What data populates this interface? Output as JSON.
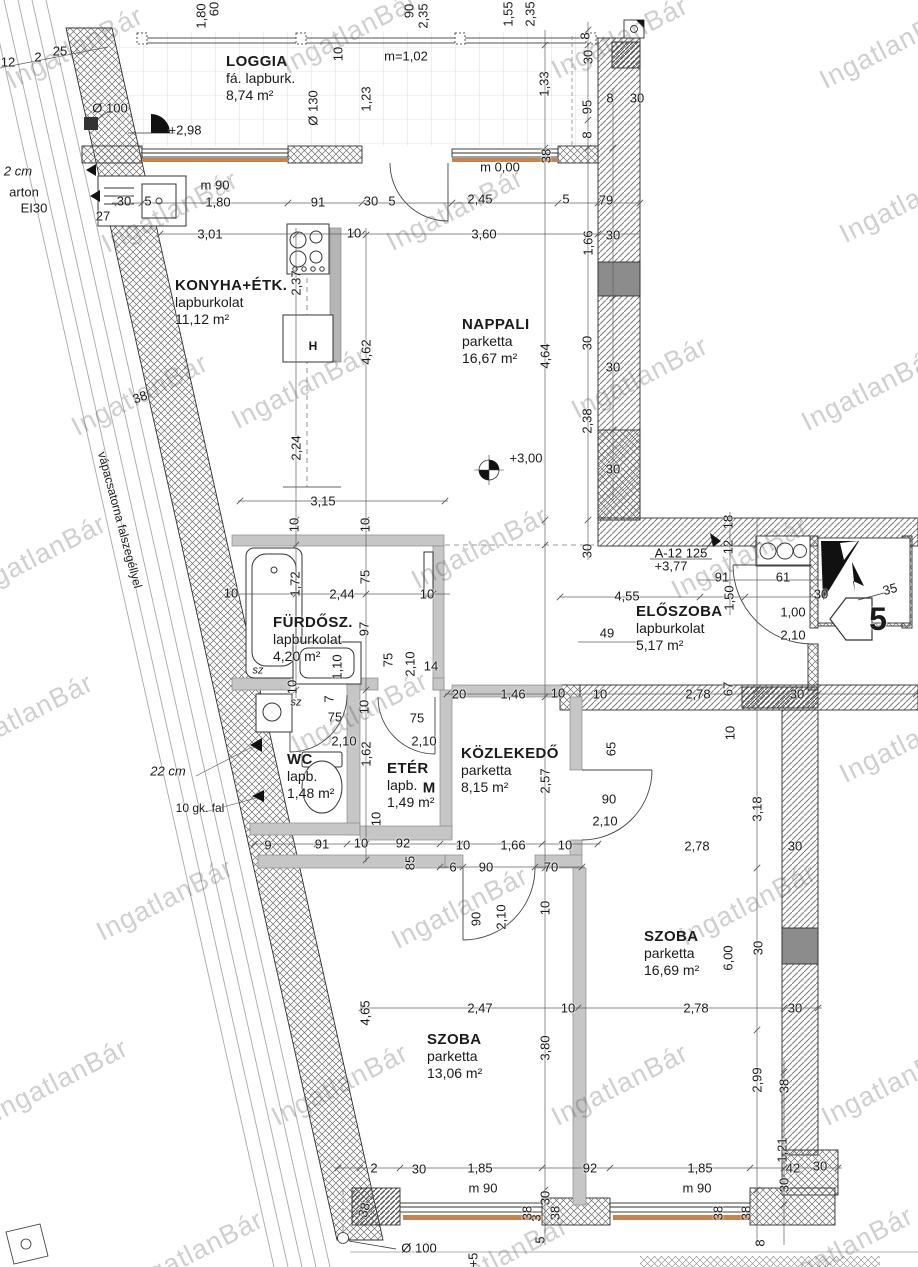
{
  "watermark_text": "IngatlanBár",
  "plan": {
    "apartment_number": "5",
    "shaft_label": "A-12 125",
    "shaft_level": "+3,77"
  },
  "rooms": [
    {
      "name": "LOGGIA",
      "finish": "fá. lapburk.",
      "area": "8,74 m²",
      "x": 226,
      "y": 53
    },
    {
      "name": "KONYHA+ÉTK.",
      "finish": "lapburkolat",
      "area": "11,12 m²",
      "x": 175,
      "y": 277
    },
    {
      "name": "NAPPALI",
      "finish": "parketta",
      "area": "16,67 m²",
      "x": 462,
      "y": 316
    },
    {
      "name": "FÜRDŐSZ.",
      "finish": "lapburkolat",
      "area": "4,20 m²",
      "x": 273,
      "y": 614
    },
    {
      "name": "ELŐSZOBA",
      "finish": "lapburkolat",
      "area": "5,17 m²",
      "x": 636,
      "y": 603
    },
    {
      "name": "WC",
      "finish": "lapb.",
      "area": "1,48 m²",
      "x": 287,
      "y": 751
    },
    {
      "name": "ETÉR",
      "finish": "lapb.",
      "area": "1,49 m²",
      "x": 387,
      "y": 760
    },
    {
      "name": "KÖZLEKEDŐ",
      "finish": "parketta",
      "area": "8,15 m²",
      "x": 461,
      "y": 745
    },
    {
      "name": "SZOBA",
      "finish": "parketta",
      "area": "16,69 m²",
      "x": 644,
      "y": 928
    },
    {
      "name": "SZOBA",
      "finish": "parketta",
      "area": "13,06 m²",
      "x": 427,
      "y": 1031
    }
  ],
  "labels": [
    {
      "t": "1,80",
      "x": 201,
      "y": 16,
      "r": -90
    },
    {
      "t": "60",
      "x": 214,
      "y": 9,
      "r": -90
    },
    {
      "t": "90",
      "x": 409,
      "y": 11,
      "r": -90
    },
    {
      "t": "2,35",
      "x": 423,
      "y": 16,
      "r": -90
    },
    {
      "t": "1,55",
      "x": 508,
      "y": 14,
      "r": -90
    },
    {
      "t": "2,35",
      "x": 530,
      "y": 14,
      "r": -90
    },
    {
      "t": "25",
      "x": 60,
      "y": 51
    },
    {
      "t": "2",
      "x": 38,
      "y": 57
    },
    {
      "t": "12",
      "x": 8,
      "y": 62
    },
    {
      "t": "m=1,02",
      "x": 406,
      "y": 56
    },
    {
      "t": "10",
      "x": 338,
      "y": 54,
      "r": -90
    },
    {
      "t": "1,23",
      "x": 366,
      "y": 99,
      "r": -90
    },
    {
      "t": "Ø 130",
      "x": 313,
      "y": 108,
      "r": -90
    },
    {
      "t": "Ø 100",
      "x": 110,
      "y": 108
    },
    {
      "t": "+2,98",
      "x": 185,
      "y": 130
    },
    {
      "t": "8",
      "x": 585,
      "y": 36,
      "r": -90
    },
    {
      "t": "30",
      "x": 588,
      "y": 57,
      "r": -90
    },
    {
      "t": "1,33",
      "x": 544,
      "y": 84,
      "r": -90
    },
    {
      "t": "95",
      "x": 587,
      "y": 107,
      "r": -90
    },
    {
      "t": "8",
      "x": 587,
      "y": 135,
      "r": -90
    },
    {
      "t": "8",
      "x": 610,
      "y": 98
    },
    {
      "t": "30",
      "x": 637,
      "y": 98
    },
    {
      "t": "38",
      "x": 546,
      "y": 156,
      "r": -90
    },
    {
      "t": "m 0,00",
      "x": 500,
      "y": 167
    },
    {
      "t": "m 90",
      "x": 215,
      "y": 185
    },
    {
      "t": "30",
      "x": 124,
      "y": 201
    },
    {
      "t": "5",
      "x": 148,
      "y": 201
    },
    {
      "t": "1,80",
      "x": 218,
      "y": 202
    },
    {
      "t": "91",
      "x": 318,
      "y": 202
    },
    {
      "t": "30",
      "x": 371,
      "y": 201
    },
    {
      "t": "5",
      "x": 392,
      "y": 201
    },
    {
      "t": "2,45",
      "x": 480,
      "y": 199
    },
    {
      "t": "5",
      "x": 566,
      "y": 199
    },
    {
      "t": "79",
      "x": 606,
      "y": 200
    },
    {
      "t": "27",
      "x": 103,
      "y": 216
    },
    {
      "t": "3,01",
      "x": 210,
      "y": 234
    },
    {
      "t": "10",
      "x": 354,
      "y": 233
    },
    {
      "t": "3,60",
      "x": 484,
      "y": 234
    },
    {
      "t": "30",
      "x": 613,
      "y": 235
    },
    {
      "t": "1,66",
      "x": 588,
      "y": 243,
      "r": -90
    },
    {
      "t": "2,37",
      "x": 296,
      "y": 283,
      "r": -90
    },
    {
      "t": "4,62",
      "x": 366,
      "y": 352,
      "r": -90
    },
    {
      "t": "4,64",
      "x": 545,
      "y": 356,
      "r": -90
    },
    {
      "t": "30",
      "x": 587,
      "y": 343,
      "r": -90
    },
    {
      "t": "30",
      "x": 613,
      "y": 367
    },
    {
      "t": "2,38",
      "x": 587,
      "y": 421,
      "r": -90
    },
    {
      "t": "30",
      "x": 613,
      "y": 469
    },
    {
      "t": "+3,00",
      "x": 526,
      "y": 458
    },
    {
      "t": "38",
      "x": 140,
      "y": 397,
      "r": -20
    },
    {
      "t": "2,24",
      "x": 296,
      "y": 448,
      "r": -90
    },
    {
      "t": "3,15",
      "x": 323,
      "y": 501
    },
    {
      "t": "10",
      "x": 294,
      "y": 525,
      "r": -90
    },
    {
      "t": "10",
      "x": 365,
      "y": 525,
      "r": -90
    },
    {
      "t": "1,72",
      "x": 295,
      "y": 584,
      "r": -90
    },
    {
      "t": "2,44",
      "x": 342,
      "y": 594
    },
    {
      "t": "75",
      "x": 365,
      "y": 577,
      "r": -90
    },
    {
      "t": "10",
      "x": 231,
      "y": 593
    },
    {
      "t": "10",
      "x": 427,
      "y": 594
    },
    {
      "t": "97",
      "x": 364,
      "y": 629,
      "r": -90
    },
    {
      "t": "sz",
      "x": 258,
      "y": 671,
      "s": 11,
      "i": 1
    },
    {
      "t": "sz",
      "x": 296,
      "y": 703,
      "s": 11,
      "i": 1
    },
    {
      "t": "1,10",
      "x": 337,
      "y": 667,
      "r": -90
    },
    {
      "t": "75",
      "x": 388,
      "y": 660,
      "r": -90
    },
    {
      "t": "2,10",
      "x": 410,
      "y": 664,
      "r": -90
    },
    {
      "t": "14",
      "x": 431,
      "y": 666
    },
    {
      "t": "18",
      "x": 728,
      "y": 522,
      "r": -90
    },
    {
      "t": "12",
      "x": 728,
      "y": 547,
      "r": -90
    },
    {
      "t": "30",
      "x": 587,
      "y": 551,
      "r": -90
    },
    {
      "t": "A-12 125",
      "x": 681,
      "y": 553
    },
    {
      "t": "+3,77",
      "x": 671,
      "y": 566
    },
    {
      "t": "91",
      "x": 722,
      "y": 577
    },
    {
      "t": "61",
      "x": 783,
      "y": 577
    },
    {
      "t": "4,55",
      "x": 627,
      "y": 596
    },
    {
      "t": "1,50",
      "x": 729,
      "y": 598,
      "r": -90
    },
    {
      "t": "30",
      "x": 821,
      "y": 594
    },
    {
      "t": "35",
      "x": 890,
      "y": 589,
      "r": -15
    },
    {
      "t": "1,00",
      "x": 793,
      "y": 612
    },
    {
      "t": "2,10",
      "x": 793,
      "y": 635
    },
    {
      "t": "49",
      "x": 607,
      "y": 633
    },
    {
      "t": "5",
      "x": 878,
      "y": 619,
      "s": 32,
      "b": 1,
      "n": "apartment-number"
    },
    {
      "t": "20",
      "x": 459,
      "y": 694
    },
    {
      "t": "1,46",
      "x": 513,
      "y": 694
    },
    {
      "t": "10",
      "x": 558,
      "y": 693
    },
    {
      "t": "10",
      "x": 600,
      "y": 694
    },
    {
      "t": "2,78",
      "x": 698,
      "y": 694
    },
    {
      "t": "67",
      "x": 728,
      "y": 689,
      "r": -90
    },
    {
      "t": "30",
      "x": 797,
      "y": 694
    },
    {
      "t": "10",
      "x": 292,
      "y": 687,
      "r": -90
    },
    {
      "t": "7",
      "x": 329,
      "y": 699,
      "r": -90
    },
    {
      "t": "10",
      "x": 364,
      "y": 707,
      "r": -90
    },
    {
      "t": "75",
      "x": 335,
      "y": 717
    },
    {
      "t": "2,10",
      "x": 344,
      "y": 741
    },
    {
      "t": "75",
      "x": 417,
      "y": 718
    },
    {
      "t": "2,10",
      "x": 424,
      "y": 741
    },
    {
      "t": "1,62",
      "x": 366,
      "y": 754,
      "r": -90
    },
    {
      "t": "2,57",
      "x": 545,
      "y": 781,
      "r": -90
    },
    {
      "t": "65",
      "x": 611,
      "y": 749,
      "r": -90
    },
    {
      "t": "10",
      "x": 730,
      "y": 733,
      "r": -90
    },
    {
      "t": "90",
      "x": 609,
      "y": 799
    },
    {
      "t": "2,10",
      "x": 605,
      "y": 821
    },
    {
      "t": "3,18",
      "x": 757,
      "y": 809,
      "r": -90
    },
    {
      "t": "10",
      "x": 376,
      "y": 819,
      "r": -90
    },
    {
      "t": "9",
      "x": 268,
      "y": 845
    },
    {
      "t": "91",
      "x": 322,
      "y": 844
    },
    {
      "t": "10",
      "x": 361,
      "y": 843
    },
    {
      "t": "92",
      "x": 403,
      "y": 843
    },
    {
      "t": "85",
      "x": 410,
      "y": 863,
      "r": -90
    },
    {
      "t": "10",
      "x": 463,
      "y": 845
    },
    {
      "t": "1,66",
      "x": 513,
      "y": 845
    },
    {
      "t": "10",
      "x": 565,
      "y": 845
    },
    {
      "t": "2,78",
      "x": 697,
      "y": 846
    },
    {
      "t": "30",
      "x": 795,
      "y": 846
    },
    {
      "t": "6",
      "x": 453,
      "y": 867
    },
    {
      "t": "90",
      "x": 486,
      "y": 867
    },
    {
      "t": "70",
      "x": 551,
      "y": 867
    },
    {
      "t": "90",
      "x": 476,
      "y": 919,
      "r": -90
    },
    {
      "t": "2,10",
      "x": 501,
      "y": 917,
      "r": -90
    },
    {
      "t": "10",
      "x": 545,
      "y": 908,
      "r": -90
    },
    {
      "t": "30",
      "x": 758,
      "y": 948,
      "r": -90
    },
    {
      "t": "6,00",
      "x": 728,
      "y": 958,
      "r": -90
    },
    {
      "t": "4,65",
      "x": 365,
      "y": 1013,
      "r": -90
    },
    {
      "t": "2,47",
      "x": 480,
      "y": 1008
    },
    {
      "t": "10",
      "x": 568,
      "y": 1008
    },
    {
      "t": "3,80",
      "x": 545,
      "y": 1048,
      "r": -90
    },
    {
      "t": "2,78",
      "x": 696,
      "y": 1008
    },
    {
      "t": "30",
      "x": 795,
      "y": 1008
    },
    {
      "t": "2,99",
      "x": 757,
      "y": 1080,
      "r": -90
    },
    {
      "t": "38",
      "x": 784,
      "y": 1086,
      "r": -90
    },
    {
      "t": "1,21",
      "x": 782,
      "y": 1150,
      "r": -90
    },
    {
      "t": "42",
      "x": 793,
      "y": 1168
    },
    {
      "t": "30",
      "x": 820,
      "y": 1166
    },
    {
      "t": "30",
      "x": 784,
      "y": 1185,
      "r": -90
    },
    {
      "t": "2",
      "x": 374,
      "y": 1168
    },
    {
      "t": "30",
      "x": 419,
      "y": 1169
    },
    {
      "t": "1,85",
      "x": 480,
      "y": 1168
    },
    {
      "t": "92",
      "x": 590,
      "y": 1168
    },
    {
      "t": "1,85",
      "x": 700,
      "y": 1168
    },
    {
      "t": "m 90",
      "x": 483,
      "y": 1188
    },
    {
      "t": "m 90",
      "x": 697,
      "y": 1188
    },
    {
      "t": "38",
      "x": 364,
      "y": 1210,
      "r": -75
    },
    {
      "t": "30",
      "x": 545,
      "y": 1198,
      "r": -90
    },
    {
      "t": "3",
      "x": 536,
      "y": 1218,
      "r": -90
    },
    {
      "t": "5",
      "x": 540,
      "y": 1240,
      "r": -90
    },
    {
      "t": "38",
      "x": 527,
      "y": 1213,
      "r": -90
    },
    {
      "t": "38",
      "x": 555,
      "y": 1213,
      "r": -90
    },
    {
      "t": "38",
      "x": 718,
      "y": 1213,
      "r": -90
    },
    {
      "t": "38",
      "x": 746,
      "y": 1213,
      "r": -90
    },
    {
      "t": "8",
      "x": 760,
      "y": 1243,
      "r": -90
    },
    {
      "t": "Ø 100",
      "x": 419,
      "y": 1248
    },
    {
      "t": "+5",
      "x": 473,
      "y": 1260,
      "r": -90
    },
    {
      "t": "2 cm",
      "x": 18,
      "y": 171,
      "i": 1
    },
    {
      "t": "arton",
      "x": 24,
      "y": 192
    },
    {
      "t": "EI30",
      "x": 34,
      "y": 208
    },
    {
      "t": "22 cm",
      "x": 168,
      "y": 771,
      "i": 1
    },
    {
      "t": "10 gk. fal",
      "x": 200,
      "y": 808,
      "s": 12
    },
    {
      "t": "vápacsatorna falszegéllyel",
      "x": 120,
      "y": 520,
      "r": 75,
      "s": 12,
      "n": "wall-note"
    },
    {
      "t": "H",
      "x": 313,
      "y": 346,
      "s": 12,
      "b": 1,
      "n": "appliance-h-label"
    },
    {
      "t": "M",
      "x": 429,
      "y": 788,
      "s": 15,
      "b": 1,
      "n": "appliance-m-label"
    }
  ],
  "watermarks": [
    {
      "x": 75,
      "y": 48
    },
    {
      "x": 350,
      "y": 33
    },
    {
      "x": 620,
      "y": 38
    },
    {
      "x": 888,
      "y": 48
    },
    {
      "x": 170,
      "y": 212
    },
    {
      "x": 455,
      "y": 210
    },
    {
      "x": 908,
      "y": 202
    },
    {
      "x": 140,
      "y": 395
    },
    {
      "x": 300,
      "y": 388
    },
    {
      "x": 640,
      "y": 378
    },
    {
      "x": 870,
      "y": 390
    },
    {
      "x": 38,
      "y": 556
    },
    {
      "x": 480,
      "y": 548
    },
    {
      "x": 740,
      "y": 558
    },
    {
      "x": 25,
      "y": 715
    },
    {
      "x": 360,
      "y": 713
    },
    {
      "x": 908,
      "y": 742
    },
    {
      "x": 165,
      "y": 900
    },
    {
      "x": 460,
      "y": 908
    },
    {
      "x": 748,
      "y": 905
    },
    {
      "x": 60,
      "y": 1080
    },
    {
      "x": 340,
      "y": 1085
    },
    {
      "x": 620,
      "y": 1085
    },
    {
      "x": 890,
      "y": 1085
    },
    {
      "x": 195,
      "y": 1252
    },
    {
      "x": 500,
      "y": 1258
    },
    {
      "x": 845,
      "y": 1248
    }
  ]
}
